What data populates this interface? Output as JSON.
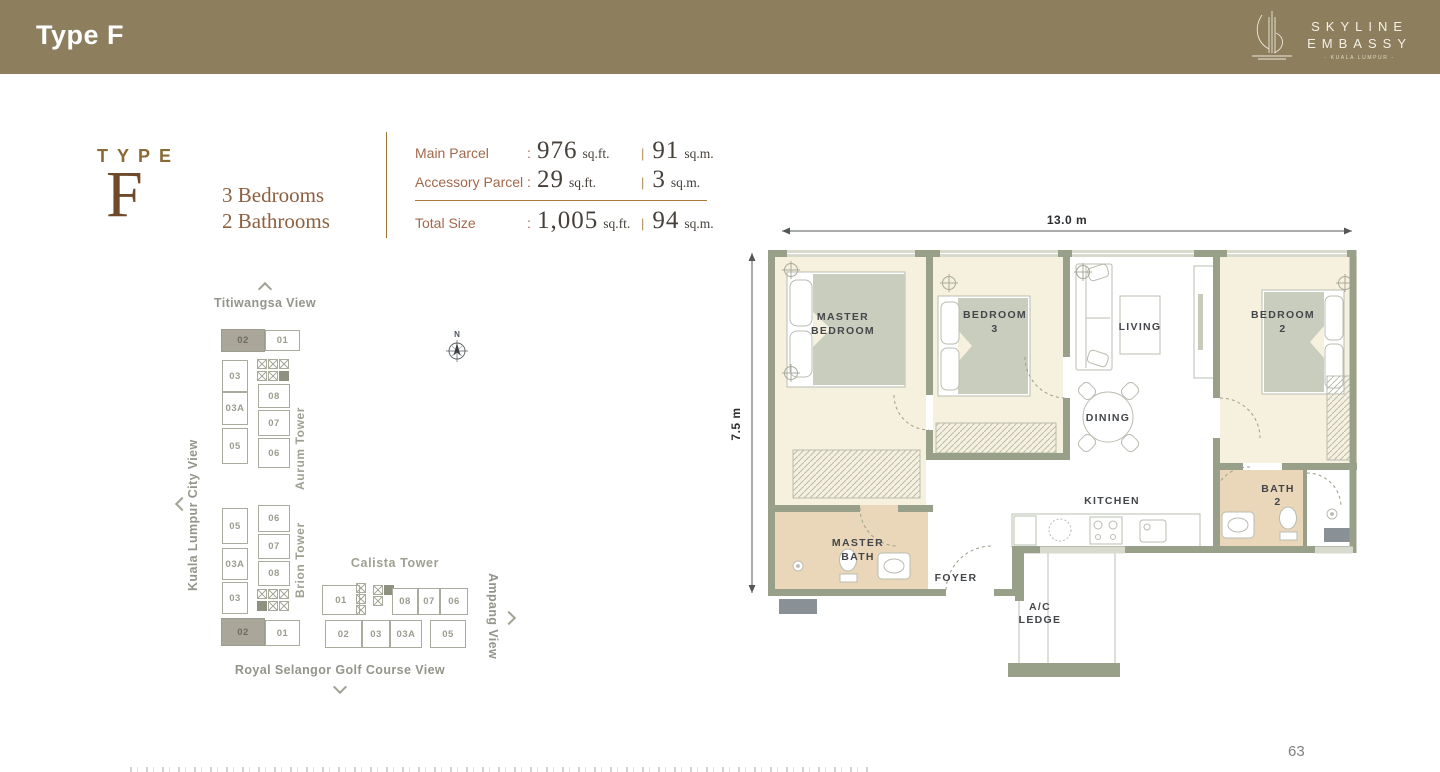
{
  "header": {
    "title": "Type F",
    "brand": {
      "line1": "SKYLINE",
      "line2": "EMBASSY",
      "tagline": "- KUALA LUMPUR -"
    }
  },
  "unit_info": {
    "type_label": "TYPE",
    "type_letter": "F",
    "bed_bath": [
      "3 Bedrooms",
      "2 Bathrooms"
    ],
    "areas": [
      {
        "label": "Main Parcel",
        "colon": ":",
        "sqft": "976",
        "sqft_unit": "sq.ft.",
        "sep": "|",
        "sqm": "91",
        "sqm_unit": "sq.m."
      },
      {
        "label": "Accessory Parcel",
        "colon": ":",
        "sqft": "29",
        "sqft_unit": "sq.ft.",
        "sep": "|",
        "sqm": "3",
        "sqm_unit": "sq.m."
      },
      {
        "label": "Total Size",
        "colon": ":",
        "sqft": "1,005",
        "sqft_unit": "sq.ft.",
        "sep": "|",
        "sqm": "94",
        "sqm_unit": "sq.m."
      }
    ]
  },
  "site_plan": {
    "north": "N",
    "views": {
      "top": "Titiwangsa View",
      "left": "Kuala Lumpur City View",
      "right": "Ampang View",
      "bottom": "Royal Selangor Golf Course View"
    },
    "towers": {
      "aurum": {
        "name": "Aurum Tower",
        "top_row": [
          "02",
          "01"
        ],
        "left_col": [
          "03",
          "03A",
          "05"
        ],
        "mid_col": [
          "08",
          "07",
          "06"
        ]
      },
      "brion": {
        "name": "Brion Tower",
        "left_col": [
          "05",
          "03A",
          "03"
        ],
        "mid_col": [
          "06",
          "07",
          "08"
        ],
        "bottom_row": [
          "02",
          "01"
        ]
      },
      "calista": {
        "name": "Calista Tower",
        "top_row": [
          "01",
          "08",
          "07",
          "06"
        ],
        "bottom_row": [
          "02",
          "03",
          "03A",
          "05"
        ]
      }
    },
    "highlighted_unit": "02"
  },
  "floorplan": {
    "dim_width": "13.0 m",
    "dim_height": "7.5 m",
    "rooms": {
      "master_bedroom": [
        "MASTER",
        "BEDROOM"
      ],
      "bedroom3": [
        "BEDROOM",
        "3"
      ],
      "living": [
        "LIVING"
      ],
      "bedroom2": [
        "BEDROOM",
        "2"
      ],
      "dining": [
        "DINING"
      ],
      "kitchen": [
        "KITCHEN"
      ],
      "master_bath": [
        "MASTER",
        "BATH"
      ],
      "bath2": [
        "BATH",
        "2"
      ],
      "foyer": [
        "FOYER"
      ],
      "ac_ledge": [
        "A/C",
        "LEDGE"
      ]
    }
  },
  "footer": {
    "page_number": "63"
  },
  "colors": {
    "header_bg": "#8d7e5e",
    "gold_accent": "#9c7434",
    "type_letter_brown": "#6f4a2a",
    "body_brown": "#8d6040",
    "wall_olive": "#99a089",
    "room_cream": "#f6f1de",
    "bath_tan": "#ead7b9",
    "site_gray": "#9fa092",
    "highlight_taupe": "#aaa79a"
  }
}
